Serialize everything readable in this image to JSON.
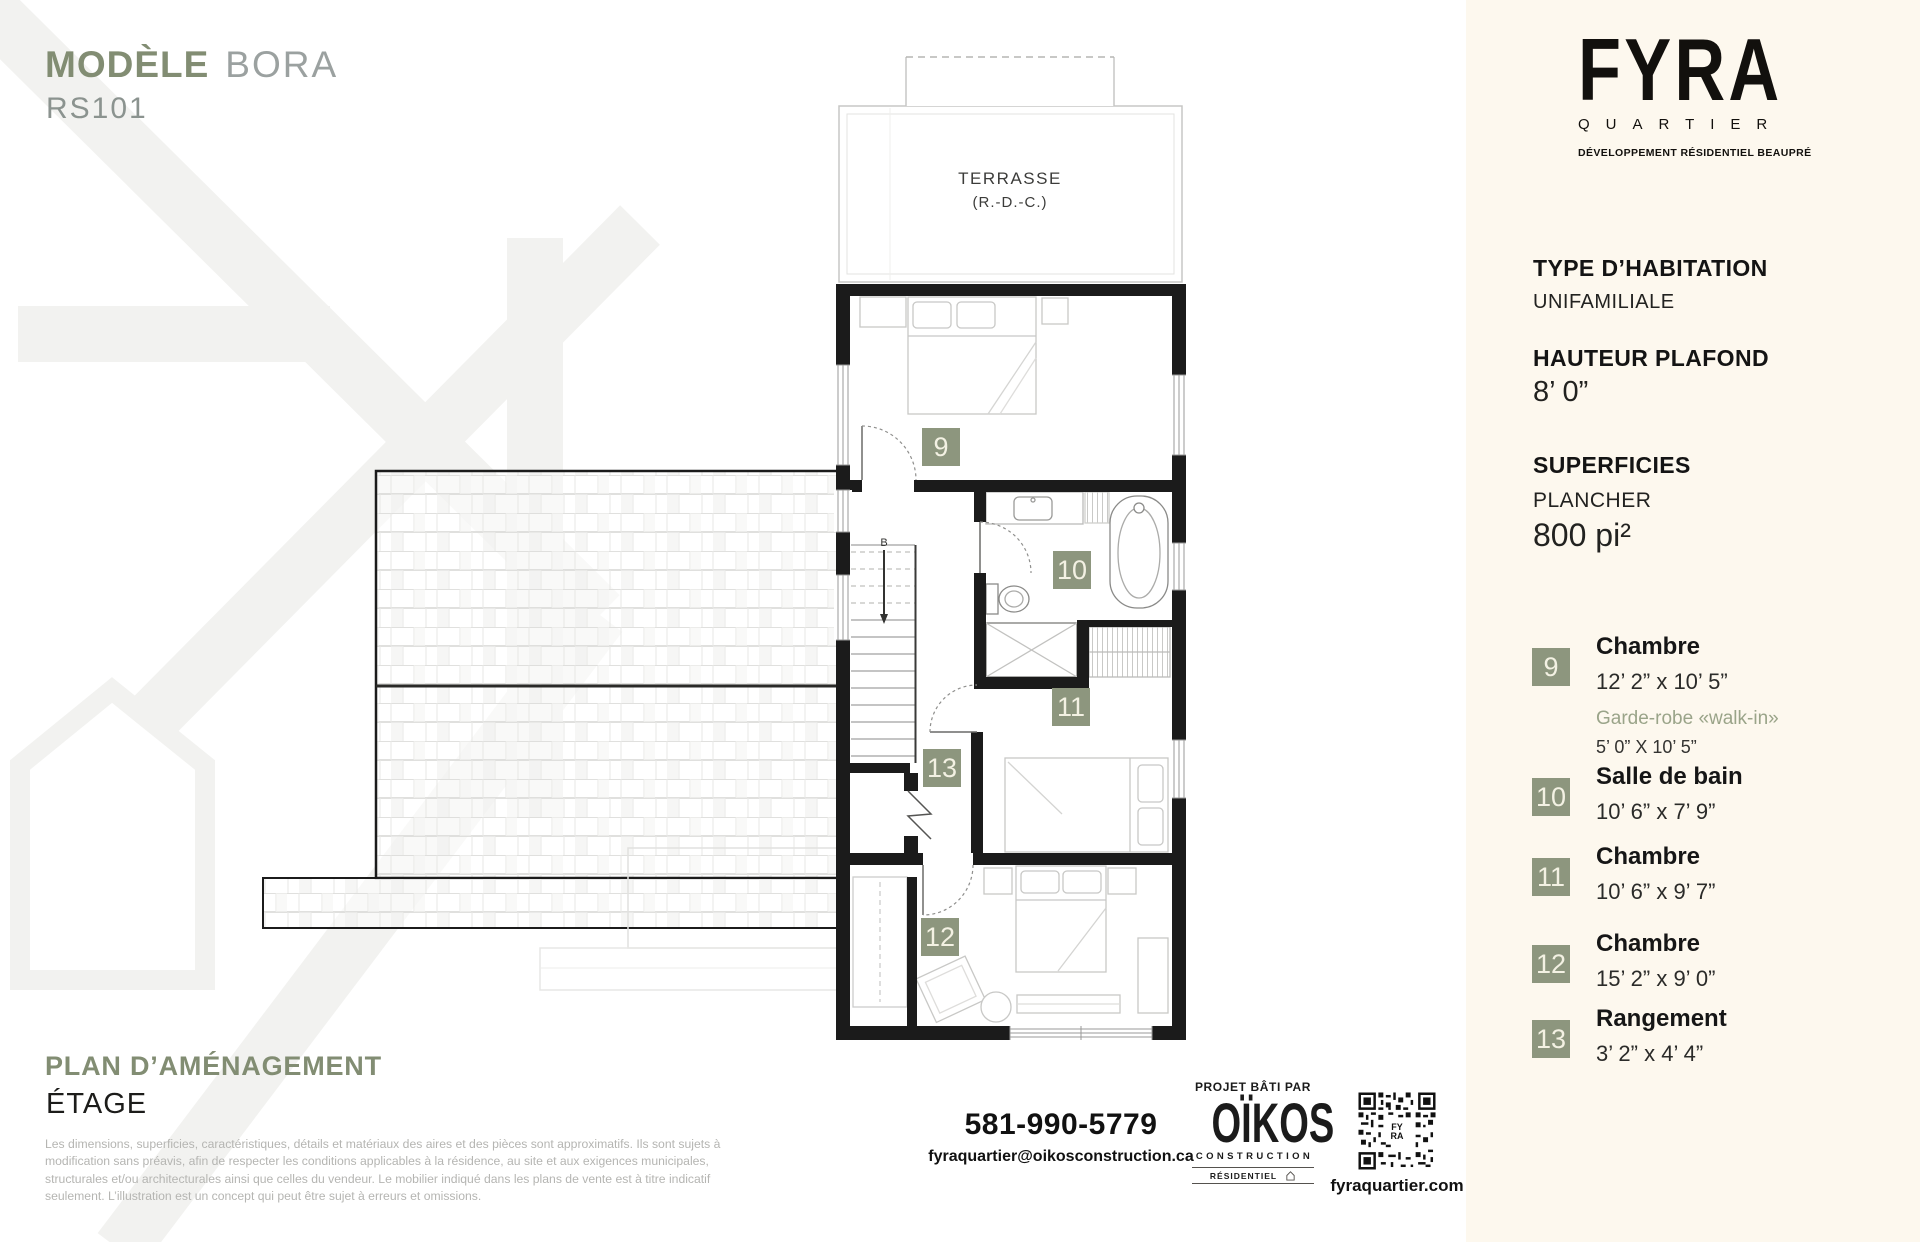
{
  "header": {
    "model_label": "MODÈLE",
    "model_name": "BORA",
    "model_code": "RS101"
  },
  "brand": {
    "name": "FYRA",
    "sub": "QUARTIER",
    "tagline": "DÉVELOPPEMENT RÉSIDENTIEL BEAUPRÉ"
  },
  "specs": {
    "type_title": "TYPE D’HABITATION",
    "type_value": "UNIFAMILIALE",
    "ceiling_title": "HAUTEUR PLAFOND",
    "ceiling_value": "8’ 0”",
    "areas_title": "SUPERFICIES",
    "floor_label": "PLANCHER",
    "floor_value": "800 pi²"
  },
  "legend": [
    {
      "num": "9",
      "name": "Chambre",
      "dims": "12’ 2” x 10’ 5”",
      "extra_name": "Garde-robe «walk-in»",
      "extra_dims": "5’ 0” X 10’ 5”"
    },
    {
      "num": "10",
      "name": "Salle de bain",
      "dims": "10’ 6” x 7’ 9”"
    },
    {
      "num": "11",
      "name": "Chambre",
      "dims": "10’ 6” x 9’ 7”"
    },
    {
      "num": "12",
      "name": "Chambre",
      "dims": "15’ 2” x 9’ 0”"
    },
    {
      "num": "13",
      "name": "Rangement",
      "dims": "3’ 2” x 4’ 4”"
    }
  ],
  "plan": {
    "terrasse_label": "TERRASSE",
    "terrasse_sub": "(R.-D.-C.)",
    "stairs_label": "B"
  },
  "footer": {
    "plan_title": "PLAN D’AMÉNAGEMENT",
    "plan_subtitle": "ÉTAGE",
    "disclaimer": "Les dimensions, superficies, caractéristiques, détails et matériaux des aires et des pièces sont approximatifs. Ils sont sujets à modification sans préavis, afin de respecter les conditions applicables à la résidence, au site et aux exigences municipales, structurales et/ou architecturales ainsi que celles du vendeur. Le mobilier indiqué dans les plans de vente est à titre indicatif seulement. L’illustration est un concept qui peut être sujet à erreurs et omissions.",
    "phone": "581-990-5779",
    "email": "fyraquartier@oikosconstruction.ca",
    "built_by": "PROJET BÂTI PAR",
    "builder_name": "OÏKOS",
    "builder_sub": "CONSTRUCTION",
    "builder_tag": "RÉSIDENTIEL",
    "website": "fyraquartier.com"
  },
  "colors": {
    "accent_sage": "#828D73",
    "badge_sage": "#8D967E",
    "panel_cream": "#FDF8EE",
    "ink": "#1A1A1A",
    "muted_gray": "#B5B5B2",
    "watermark": "#F2F2F0"
  }
}
